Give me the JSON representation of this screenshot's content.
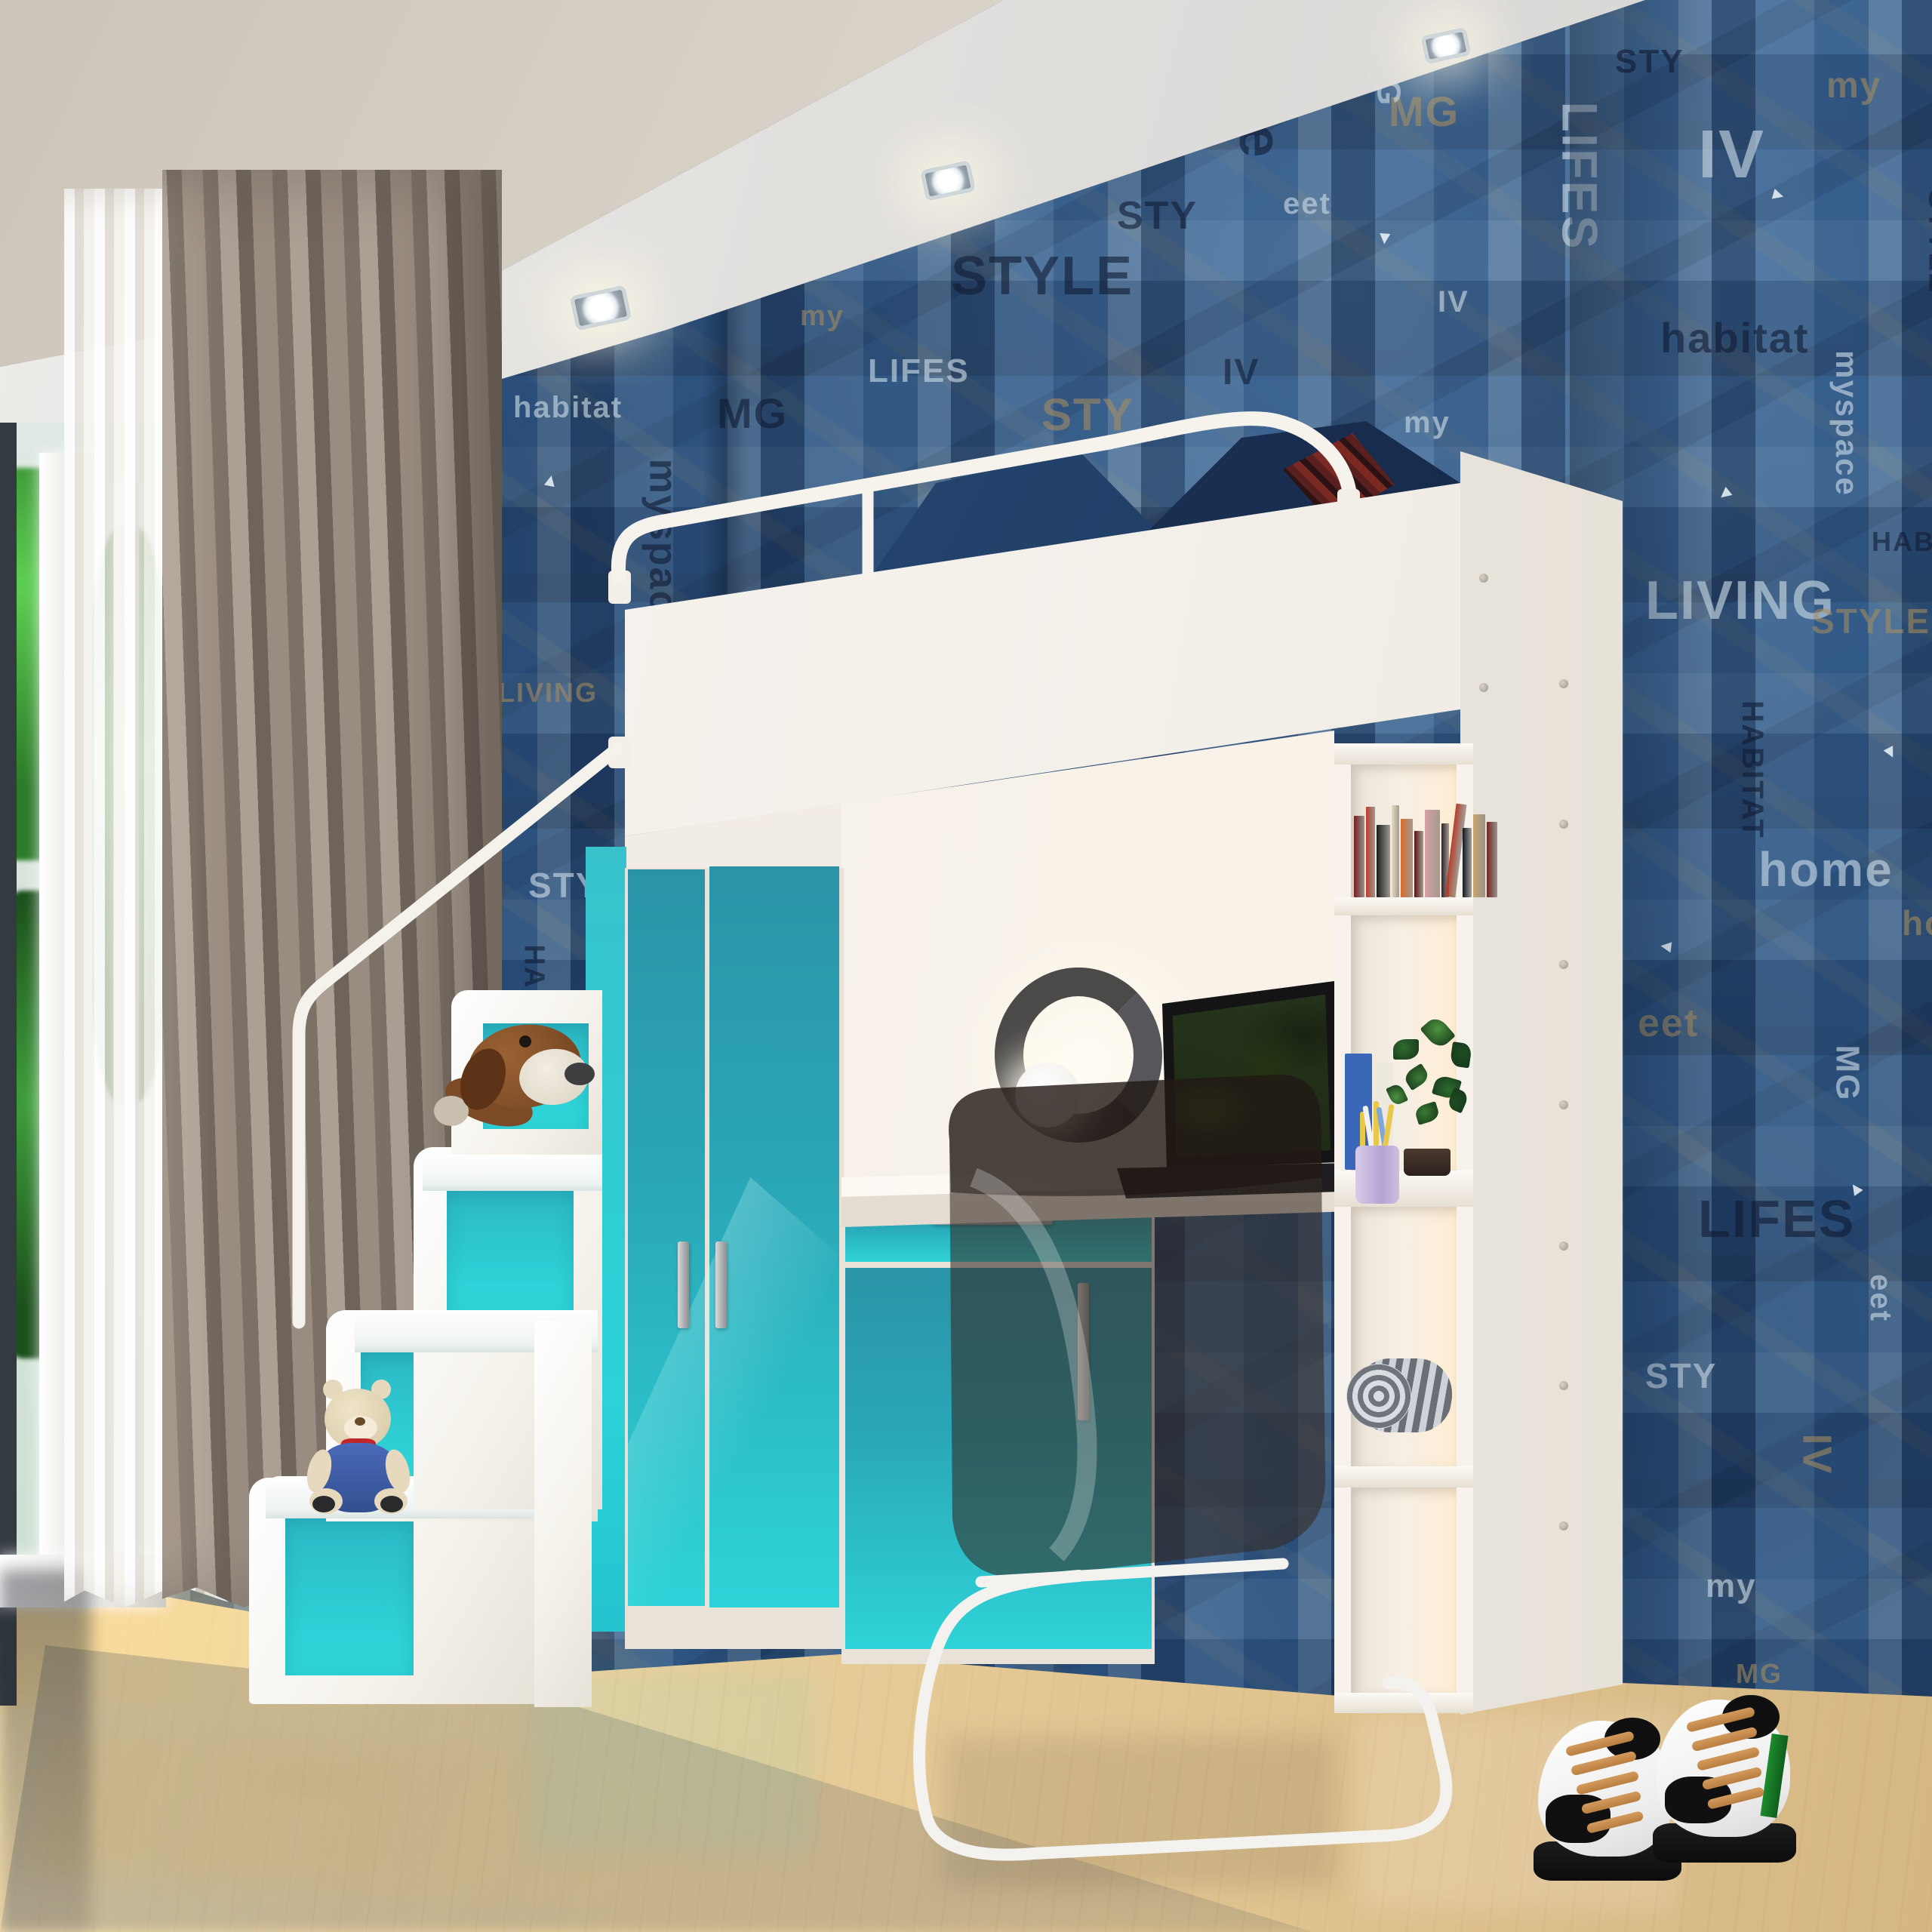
{
  "scene": {
    "title": "3D render: kids bedroom with white-and-teal loft bed (wardrobe, desk, bookshelf, storage stairs)",
    "objects": [
      "ceiling spotlights",
      "grunge typographic wallpaper",
      "window with plant view",
      "sheer curtain",
      "grey drape",
      "loft bed with guard rails",
      "denim pillows",
      "teal wardrobe",
      "teal drawer cabinet",
      "desk with laptop",
      "ring lamp",
      "smoked acrylic chair",
      "bookshelf with books, plant, pencil cup, towel roll",
      "storage stairs with handrail",
      "plush dog",
      "teddy bear",
      "high-top sneakers",
      "maple floor"
    ]
  },
  "counts": {
    "ceiling_spotlights": 3,
    "stair_steps": 4,
    "wardrobe_doors": 2
  },
  "wallpaper": {
    "words": [
      "habitat",
      "myspace",
      "LIVING",
      "STYLE",
      "HABITAT",
      "home",
      "eet",
      "MG",
      "LIFES",
      "STY",
      "IV",
      "my"
    ],
    "arrow": "▸"
  },
  "palette": {
    "wallpaper_base": "#3a6494",
    "teal_bright": "#2ed3d8",
    "teal_deep": "#2a93a8",
    "wood": "#ecd3a0",
    "ceiling_beige": "#d2cabf",
    "soffit_white": "#e9e7e4",
    "curtain_taupe": "#8d8177",
    "sheer_white": "#f1ede8",
    "bed_white": "#f5f2ec",
    "chair_smoke": "#352c25",
    "lamp_ring_grey": "#4b4a48",
    "lace_tan": "#c08a4e",
    "denim_navy": "#24426b",
    "plaid_red": "#5a1f1f",
    "plant_green": "#3c7a34",
    "pencil_cup_lavender": "#c9b8e0",
    "book_colors": [
      "#7a1f1f",
      "#c03a2b",
      "#1b1b1b",
      "#e8dcc0",
      "#d96a2a",
      "#5c1212",
      "#d7a0a8",
      "#2b2430",
      "#b5402f",
      "#101820",
      "#caa56a",
      "#76221f"
    ]
  }
}
